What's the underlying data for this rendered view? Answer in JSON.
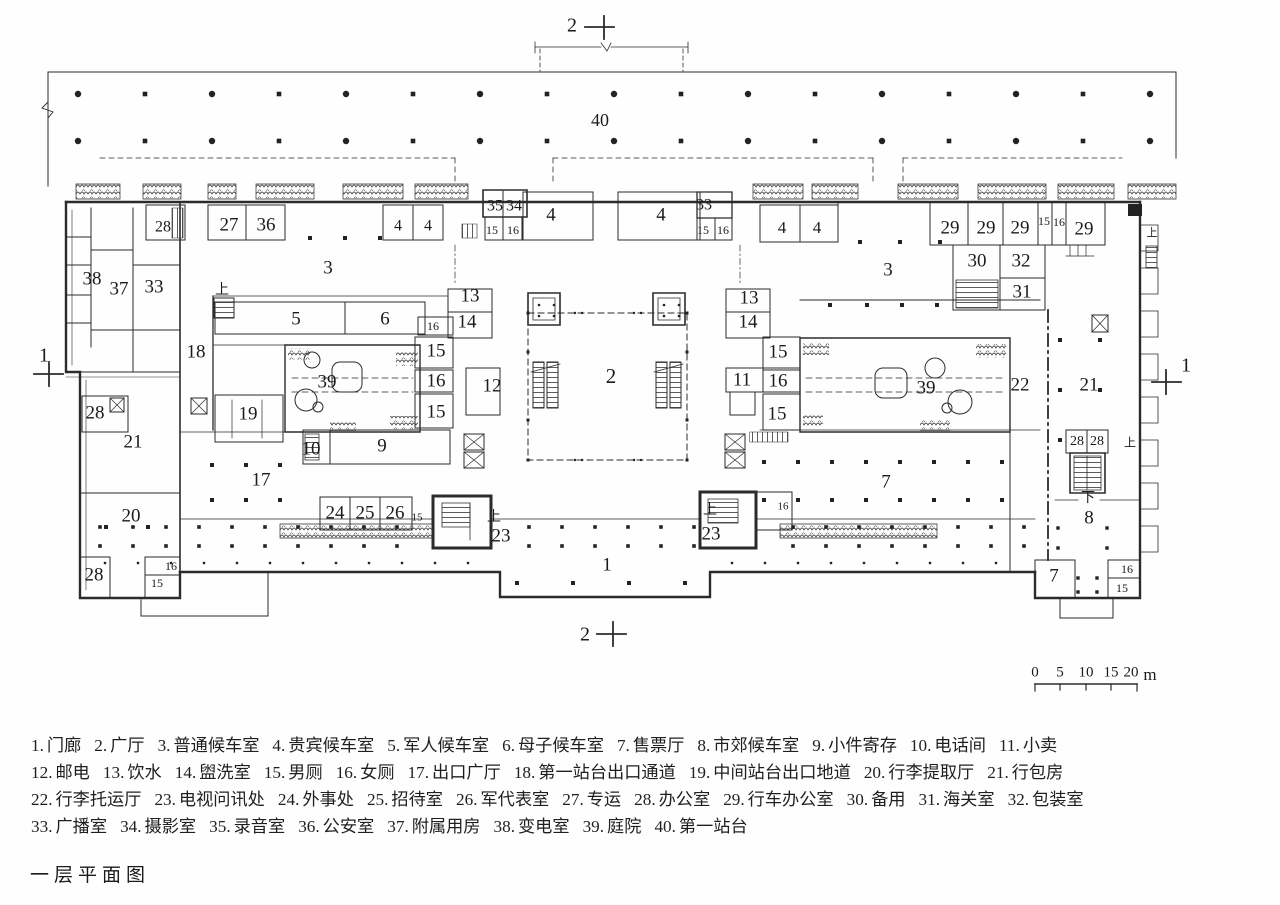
{
  "title": "一层平面图",
  "scale_bar": {
    "labels": [
      "0",
      "5",
      "10",
      "15",
      "20"
    ],
    "unit": "m"
  },
  "plan": {
    "section_marks": [
      {
        "text": "2",
        "x": 572,
        "y": 27
      },
      {
        "text": "2",
        "x": 585,
        "y": 636
      },
      {
        "text": "1",
        "x": 44,
        "y": 357
      },
      {
        "text": "1",
        "x": 1186,
        "y": 367
      }
    ],
    "room_labels": [
      {
        "text": "40",
        "x": 600,
        "y": 122,
        "fs": 18
      },
      {
        "text": "28",
        "x": 163,
        "y": 228,
        "fs": 16
      },
      {
        "text": "27",
        "x": 229,
        "y": 226
      },
      {
        "text": "36",
        "x": 266,
        "y": 226
      },
      {
        "text": "4",
        "x": 398,
        "y": 227,
        "fs": 16
      },
      {
        "text": "4",
        "x": 428,
        "y": 227,
        "fs": 16
      },
      {
        "text": "38",
        "x": 92,
        "y": 280
      },
      {
        "text": "37",
        "x": 119,
        "y": 290
      },
      {
        "text": "33",
        "x": 154,
        "y": 288
      },
      {
        "text": "35",
        "x": 495,
        "y": 207,
        "fs": 16
      },
      {
        "text": "34",
        "x": 514,
        "y": 207,
        "fs": 16
      },
      {
        "text": "15",
        "x": 492,
        "y": 231,
        "fs": 12
      },
      {
        "text": "16",
        "x": 513,
        "y": 231,
        "fs": 12
      },
      {
        "text": "4",
        "x": 551,
        "y": 216
      },
      {
        "text": "4",
        "x": 661,
        "y": 216
      },
      {
        "text": "33",
        "x": 704,
        "y": 206,
        "fs": 16
      },
      {
        "text": "15",
        "x": 703,
        "y": 231,
        "fs": 12
      },
      {
        "text": "16",
        "x": 723,
        "y": 231,
        "fs": 12
      },
      {
        "text": "4",
        "x": 782,
        "y": 229,
        "fs": 17
      },
      {
        "text": "4",
        "x": 817,
        "y": 229,
        "fs": 17
      },
      {
        "text": "29",
        "x": 950,
        "y": 229
      },
      {
        "text": "29",
        "x": 986,
        "y": 229
      },
      {
        "text": "29",
        "x": 1020,
        "y": 229
      },
      {
        "text": "15",
        "x": 1044,
        "y": 222,
        "fs": 12
      },
      {
        "text": "16",
        "x": 1059,
        "y": 223,
        "fs": 12
      },
      {
        "text": "29",
        "x": 1084,
        "y": 230
      },
      {
        "text": "30",
        "x": 977,
        "y": 262
      },
      {
        "text": "32",
        "x": 1021,
        "y": 262
      },
      {
        "text": "31",
        "x": 1022,
        "y": 293
      },
      {
        "text": "3",
        "x": 328,
        "y": 269
      },
      {
        "text": "3",
        "x": 888,
        "y": 271
      },
      {
        "text": "18",
        "x": 196,
        "y": 353
      },
      {
        "text": "5",
        "x": 296,
        "y": 320
      },
      {
        "text": "6",
        "x": 385,
        "y": 320
      },
      {
        "text": "13",
        "x": 470,
        "y": 297
      },
      {
        "text": "14",
        "x": 467,
        "y": 323
      },
      {
        "text": "16",
        "x": 433,
        "y": 327,
        "fs": 12
      },
      {
        "text": "15",
        "x": 436,
        "y": 352
      },
      {
        "text": "16",
        "x": 436,
        "y": 382
      },
      {
        "text": "12",
        "x": 492,
        "y": 387
      },
      {
        "text": "15",
        "x": 436,
        "y": 413
      },
      {
        "text": "19",
        "x": 248,
        "y": 415
      },
      {
        "text": "39",
        "x": 327,
        "y": 383
      },
      {
        "text": "39",
        "x": 926,
        "y": 389
      },
      {
        "text": "2",
        "x": 611,
        "y": 378,
        "fs": 21
      },
      {
        "text": "13",
        "x": 749,
        "y": 299
      },
      {
        "text": "14",
        "x": 748,
        "y": 323
      },
      {
        "text": "15",
        "x": 778,
        "y": 353
      },
      {
        "text": "16",
        "x": 778,
        "y": 382
      },
      {
        "text": "11",
        "x": 742,
        "y": 381
      },
      {
        "text": "15",
        "x": 777,
        "y": 415
      },
      {
        "text": "22",
        "x": 1020,
        "y": 386
      },
      {
        "text": "21",
        "x": 1089,
        "y": 386
      },
      {
        "text": "28",
        "x": 95,
        "y": 414
      },
      {
        "text": "21",
        "x": 133,
        "y": 443
      },
      {
        "text": "20",
        "x": 131,
        "y": 517
      },
      {
        "text": "28",
        "x": 94,
        "y": 576
      },
      {
        "text": "15",
        "x": 157,
        "y": 584,
        "fs": 12
      },
      {
        "text": "16",
        "x": 171,
        "y": 567,
        "fs": 12
      },
      {
        "text": "17",
        "x": 261,
        "y": 481
      },
      {
        "text": "10",
        "x": 311,
        "y": 450
      },
      {
        "text": "9",
        "x": 382,
        "y": 447
      },
      {
        "text": "24",
        "x": 335,
        "y": 514
      },
      {
        "text": "25",
        "x": 365,
        "y": 514
      },
      {
        "text": "26",
        "x": 395,
        "y": 514
      },
      {
        "text": "15",
        "x": 417,
        "y": 518,
        "fs": 11
      },
      {
        "text": "23",
        "x": 501,
        "y": 537
      },
      {
        "text": "16",
        "x": 783,
        "y": 507,
        "fs": 11
      },
      {
        "text": "23",
        "x": 711,
        "y": 535
      },
      {
        "text": "1",
        "x": 607,
        "y": 566
      },
      {
        "text": "7",
        "x": 886,
        "y": 483
      },
      {
        "text": "28",
        "x": 1077,
        "y": 442,
        "fs": 14
      },
      {
        "text": "28",
        "x": 1097,
        "y": 442,
        "fs": 14
      },
      {
        "text": "8",
        "x": 1089,
        "y": 519
      },
      {
        "text": "7",
        "x": 1054,
        "y": 577
      },
      {
        "text": "16",
        "x": 1127,
        "y": 570,
        "fs": 12
      },
      {
        "text": "15",
        "x": 1122,
        "y": 589,
        "fs": 12
      }
    ],
    "stair_labels": [
      {
        "text": "上",
        "x": 222,
        "y": 290
      },
      {
        "text": "上",
        "x": 494,
        "y": 517
      },
      {
        "text": "上",
        "x": 710,
        "y": 510
      },
      {
        "text": "上",
        "x": 1130,
        "y": 443,
        "fs": 12
      },
      {
        "text": "下",
        "x": 1088,
        "y": 498
      },
      {
        "text": "上",
        "x": 1152,
        "y": 233,
        "fs": 11
      }
    ]
  },
  "legend": {
    "lines": [
      [
        {
          "no": "1.",
          "name": "门廊"
        },
        {
          "no": "2.",
          "name": "广厅"
        },
        {
          "no": "3.",
          "name": "普通候车室"
        },
        {
          "no": "4.",
          "name": "贵宾候车室"
        },
        {
          "no": "5.",
          "name": "军人候车室"
        },
        {
          "no": "6.",
          "name": "母子候车室"
        },
        {
          "no": "7.",
          "name": "售票厅"
        },
        {
          "no": "8.",
          "name": "市郊候车室"
        },
        {
          "no": "9.",
          "name": "小件寄存"
        },
        {
          "no": "10.",
          "name": "电话间"
        },
        {
          "no": "11.",
          "name": "小卖"
        }
      ],
      [
        {
          "no": "12.",
          "name": "邮电"
        },
        {
          "no": "13.",
          "name": "饮水"
        },
        {
          "no": "14.",
          "name": "盥洗室"
        },
        {
          "no": "15.",
          "name": "男厕"
        },
        {
          "no": "16.",
          "name": "女厕"
        },
        {
          "no": "17.",
          "name": "出口广厅"
        },
        {
          "no": "18.",
          "name": "第一站台出口通道"
        },
        {
          "no": "19.",
          "name": "中间站台出口地道"
        },
        {
          "no": "20.",
          "name": "行李提取厅"
        },
        {
          "no": "21.",
          "name": "行包房"
        }
      ],
      [
        {
          "no": "22.",
          "name": "行李托运厅"
        },
        {
          "no": "23.",
          "name": "电视问讯处"
        },
        {
          "no": "24.",
          "name": "外事处"
        },
        {
          "no": "25.",
          "name": "招待室"
        },
        {
          "no": "26.",
          "name": "军代表室"
        },
        {
          "no": "27.",
          "name": "专运"
        },
        {
          "no": "28.",
          "name": "办公室"
        },
        {
          "no": "29.",
          "name": "行车办公室"
        },
        {
          "no": "30.",
          "name": "备用"
        },
        {
          "no": "31.",
          "name": "海关室"
        },
        {
          "no": "32.",
          "name": "包装室"
        }
      ],
      [
        {
          "no": "33.",
          "name": "广播室"
        },
        {
          "no": "34.",
          "name": "摄影室"
        },
        {
          "no": "35.",
          "name": "录音室"
        },
        {
          "no": "36.",
          "name": "公安室"
        },
        {
          "no": "37.",
          "name": "附属用房"
        },
        {
          "no": "38.",
          "name": "变电室"
        },
        {
          "no": "39.",
          "name": "庭院"
        },
        {
          "no": "40.",
          "name": "第一站台"
        }
      ]
    ]
  },
  "colors": {
    "ink": "#2b2b2b",
    "text": "#1b1b1b",
    "paper": "#fefefe"
  }
}
